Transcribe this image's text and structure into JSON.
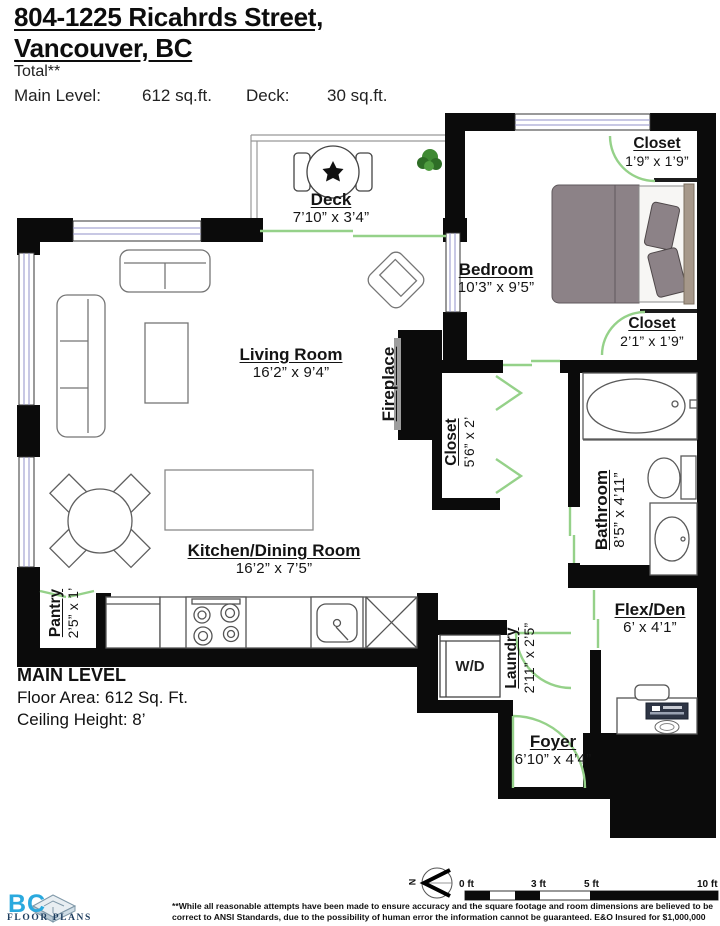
{
  "header": {
    "title_line1": "804-1225 Ricahrds Street,",
    "title_line2": "Vancouver, BC",
    "total_note": "Total**",
    "main_level_label": "Main Level:",
    "main_level_value": "612 sq.ft.",
    "deck_label": "Deck:",
    "deck_value": "30 sq.ft."
  },
  "rooms": {
    "deck": {
      "name": "Deck",
      "dims": "7’10” x 3’4”"
    },
    "closet_top": {
      "name": "Closet",
      "dims": "1’9” x 1’9”"
    },
    "bedroom": {
      "name": "Bedroom",
      "dims": "10’3” x 9’5”"
    },
    "closet_bed": {
      "name": "Closet",
      "dims": "2’1” x 1’9”"
    },
    "living": {
      "name": "Living Room",
      "dims": "16’2” x 9’4”"
    },
    "fireplace": {
      "name": "Fireplace",
      "dims": ""
    },
    "closet_hall": {
      "name": "Closet",
      "dims": "5’6” x 2’"
    },
    "bathroom": {
      "name": "Bathroom",
      "dims": "8’5” x 4’11”"
    },
    "kitchen": {
      "name": "Kitchen/Dining Room",
      "dims": "16’2” x 7’5”"
    },
    "pantry": {
      "name": "Pantry",
      "dims": "2’5” x 1’"
    },
    "laundry": {
      "name": "Laundry",
      "dims": "2’11” x 2’5”"
    },
    "wd": {
      "name": "W/D",
      "dims": ""
    },
    "foyer": {
      "name": "Foyer",
      "dims": "6’10” x 4’4”"
    },
    "flex_den": {
      "name": "Flex/Den",
      "dims": "6’ x 4’1”"
    }
  },
  "info": {
    "level": "MAIN LEVEL",
    "floor_area": "Floor Area: 612 Sq. Ft.",
    "ceiling": "Ceiling Height: 8’"
  },
  "scale_bar": {
    "labels": [
      "0 ft",
      "3 ft",
      "5 ft",
      "10 ft"
    ],
    "north": "N"
  },
  "logo": {
    "bc": "BC",
    "floor_plans": "FLOOR PLANS"
  },
  "disclaimer": "**While all reasonable attempts have been made to ensure accuracy and the square footage and room dimensions are believed to be correct to ANSI Standards, due to the possibility of human error the information cannot be guaranteed. E&O Insured for $1,000,000",
  "colors": {
    "wall": "#0b0b0b",
    "door_green": "#95d189",
    "window_blue": "#9191c8",
    "bed_gray": "#8c8287",
    "logo_blue": "#2aa9de",
    "logo_navy": "#1d3d5f"
  }
}
